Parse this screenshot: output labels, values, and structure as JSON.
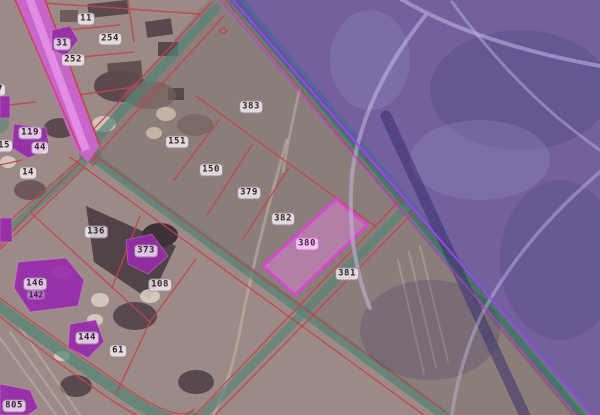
{
  "map": {
    "kind": "cadastral-parcel-map",
    "selected_parcel": "380",
    "labels": [
      {
        "text": "7",
        "x": 0,
        "y": 90
      },
      {
        "text": "11",
        "x": 86,
        "y": 19
      },
      {
        "text": "31",
        "x": 62,
        "y": 44
      },
      {
        "text": "254",
        "x": 110,
        "y": 39
      },
      {
        "text": "252",
        "x": 73,
        "y": 60
      },
      {
        "text": "119",
        "x": 30,
        "y": 133
      },
      {
        "text": "44",
        "x": 40,
        "y": 148
      },
      {
        "text": "15",
        "x": 4,
        "y": 146
      },
      {
        "text": "14",
        "x": 28,
        "y": 173
      },
      {
        "text": "136",
        "x": 96,
        "y": 232
      },
      {
        "text": "373",
        "x": 146,
        "y": 251
      },
      {
        "text": "108",
        "x": 160,
        "y": 285
      },
      {
        "text": "146",
        "x": 35,
        "y": 284
      },
      {
        "text": "142",
        "x": 36,
        "y": 295,
        "variant": "small"
      },
      {
        "text": "144",
        "x": 87,
        "y": 338
      },
      {
        "text": "61",
        "x": 118,
        "y": 351
      },
      {
        "text": "805",
        "x": 14,
        "y": 406
      },
      {
        "text": "383",
        "x": 251,
        "y": 107
      },
      {
        "text": "151",
        "x": 177,
        "y": 142
      },
      {
        "text": "150",
        "x": 211,
        "y": 170
      },
      {
        "text": "379",
        "x": 249,
        "y": 193
      },
      {
        "text": "382",
        "x": 283,
        "y": 219
      },
      {
        "text": "380",
        "x": 307,
        "y": 244,
        "variant": "selected"
      },
      {
        "text": "381",
        "x": 347,
        "y": 274
      }
    ],
    "colors": {
      "parcel_line": "#c4434e",
      "selected_fill": "rgba(236,130,228,0.42)",
      "selected_stroke": "#e23ede",
      "zone_fill": "rgba(93,72,190,0.53)",
      "zone_border": "#a743e8",
      "road_teal": "rgba(85,132,118,0.85)",
      "road_magenta": "#c765c9",
      "building_purple": "#982bab",
      "label_bg": "rgba(255,255,255,0.72)",
      "label_text": "#34222e"
    }
  }
}
